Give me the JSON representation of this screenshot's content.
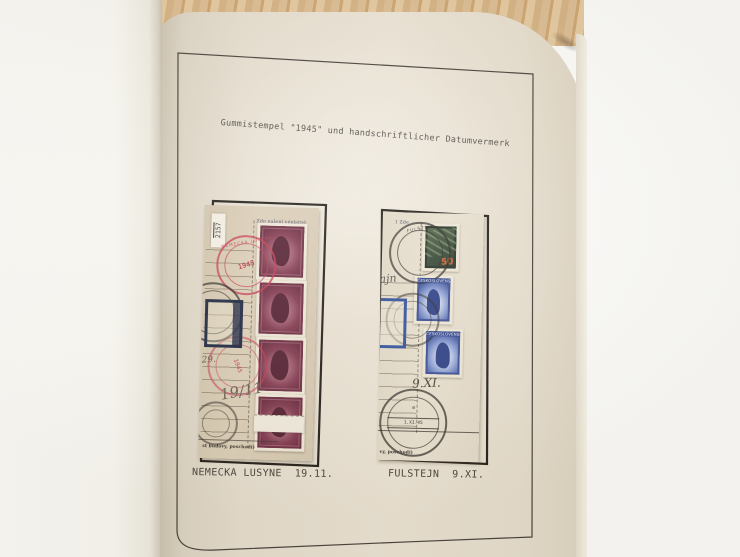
{
  "photo": {
    "heading": "Gummistempel \"1945\" und handschriftlicher Datumvermerk"
  },
  "colors": {
    "wood": "#d5b383",
    "album_page": "#e9e1d2",
    "facing_page": "#fbfaf5",
    "frame_rule": "#46413a",
    "typewriter_ink": "#54504a",
    "form_paper_left": "#d7cab2",
    "form_paper_right": "#e7dfce",
    "stamp_maroon": "#6d2b40",
    "cancel_red": "#c73a52",
    "stamp_green": "#324434",
    "overprint_orange": "#d2622e",
    "stamp_blue": "#3e57a6",
    "box_navy": "#1d2740",
    "box_blue": "#31519b",
    "postmark_black": "#2d2a24"
  },
  "exhibits": {
    "left": {
      "caption": "NEMECKA LUSYNE  19.11.",
      "registration_label": "2157",
      "form_header": "Zde nalepí výplatné",
      "form_footer": "st budovy, poschodí)",
      "handwriting_note": "29.",
      "handwriting_date": "19/11",
      "red_cancel_ring": "NEMECKA LUSYNE",
      "red_cancel_center": "1945"
    },
    "right": {
      "caption": "FULSTEJN  9.XI.",
      "form_header": "1 Zde",
      "form_footer": "vy, poschodí)",
      "handwriting_name": "ajn",
      "handwriting_date": "9.XI.",
      "postmark_ring": "FULŠTEJN",
      "postmark_center_letter": "a",
      "postmark_date": "1.XI.45",
      "green_stamp_overprint": "50",
      "blue_stamp_country": "ČESKOSLOVENSKO"
    }
  }
}
